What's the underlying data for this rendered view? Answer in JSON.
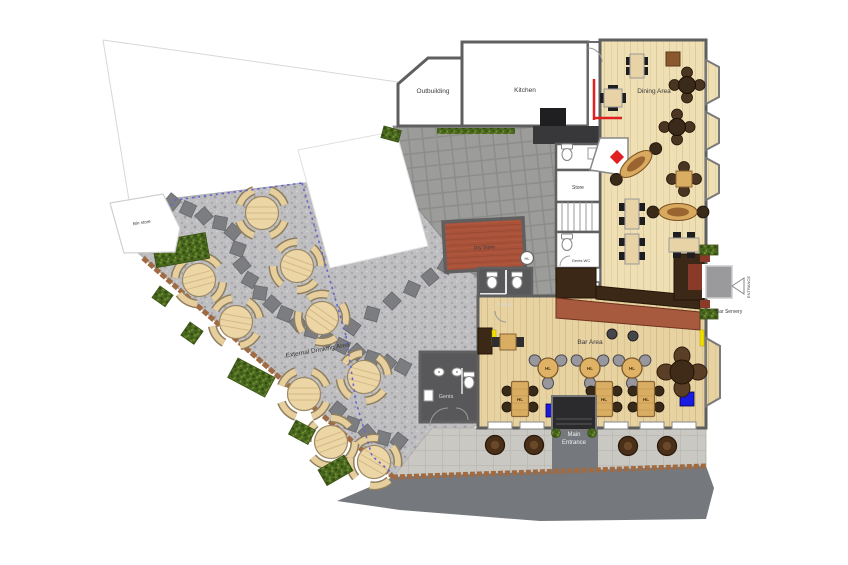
{
  "floor_plan": {
    "rooms": [
      {
        "label": "Outbuilding"
      },
      {
        "label": "Kitchen"
      },
      {
        "label": "Dining Area"
      },
      {
        "label": "Store"
      },
      {
        "label": "Dry Store"
      },
      {
        "label": "Ladies"
      },
      {
        "label": "Gents WC"
      },
      {
        "label": "Gents"
      },
      {
        "label": "Bar Area"
      },
      {
        "label": "Bin store"
      },
      {
        "label": "External Drinking Area"
      }
    ],
    "annotations": {
      "main_entrance_line1": "Main",
      "main_entrance_line2": "Entrance",
      "side_entrance": "ENTRANCE",
      "bar_servery": "Bar Servery",
      "table_tag": "HL"
    },
    "colors": {
      "wood_floor": "#eedfb4",
      "bar_wood_floor": "#e7d2a2",
      "bar_counter_dark": "#3b2817",
      "bar_counter_front": "#a85a3f",
      "dry_store_floor": "#a9523a",
      "wc_floor": "#58585a",
      "courtyard_paving": "#9c9c9a",
      "gravel": "#bfbfc1",
      "road": "#75787c",
      "hedge": "#4d6a20",
      "boundary_dashed": "#6666cc",
      "accent_red": "#e02020",
      "accent_blue": "#1a1ae0",
      "accent_yellow": "#f0e000"
    }
  }
}
